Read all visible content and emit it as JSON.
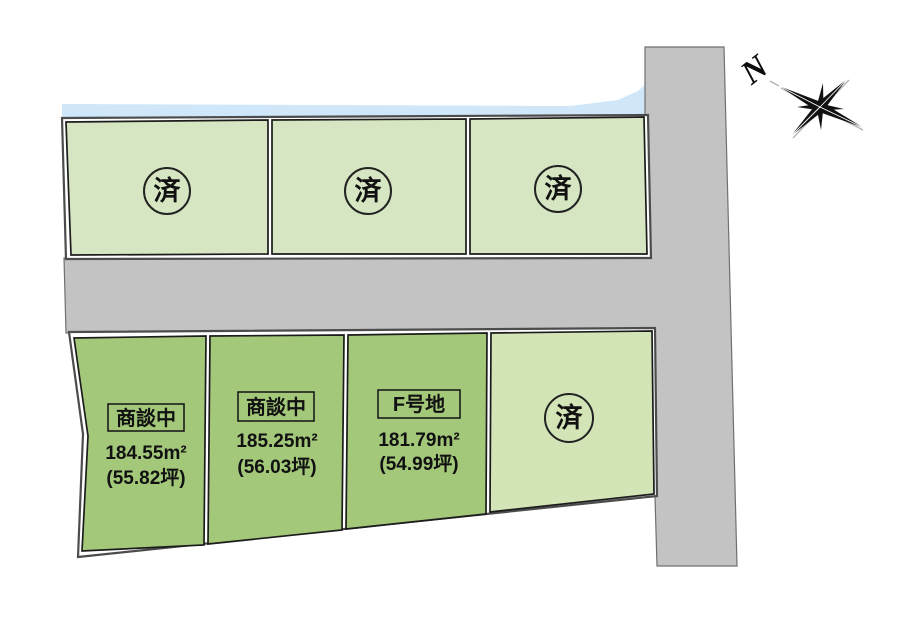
{
  "compass": {
    "north_label": "N"
  },
  "plots": {
    "top_row": [
      {
        "status": "済"
      },
      {
        "status": "済"
      },
      {
        "status": "済"
      }
    ],
    "bottom_row": [
      {
        "label": "商談中",
        "area": "184.55m²",
        "tsubo": "(55.82坪)"
      },
      {
        "label": "商談中",
        "area": "185.25m²",
        "tsubo": "(56.03坪)"
      },
      {
        "label": "F号地",
        "area": "181.79m²",
        "tsubo": "(54.99坪)"
      },
      {
        "status": "済"
      }
    ]
  },
  "colors": {
    "water": "#cfe7f8",
    "road": "#c3c3c3",
    "road_edge": "#707070",
    "sold_plot": "#d7e6c2",
    "sold_plot_south": "#d3e4b7",
    "active_plot": "#a3c87a"
  }
}
